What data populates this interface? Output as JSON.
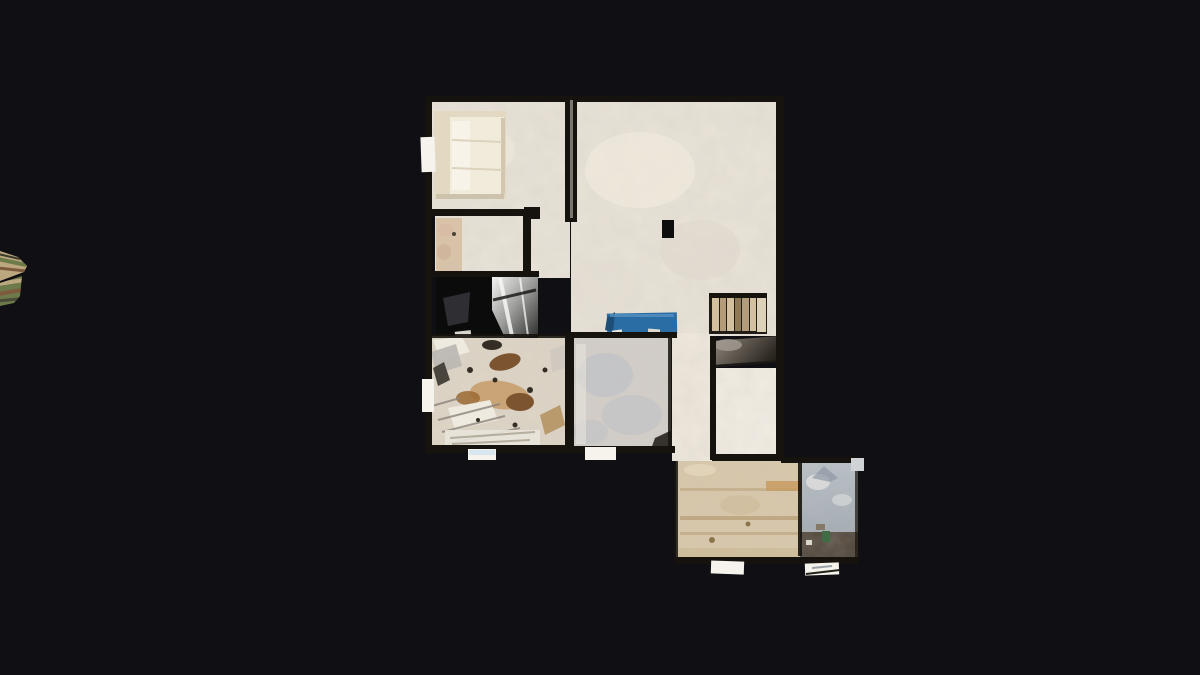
{
  "app": {
    "name": "3d-scan-floorplan-viewer",
    "view_mode": "top-down dollhouse floorplan",
    "visible_text": ""
  },
  "scene": {
    "description": "Orthographic top-down view of a 3D-scanned apartment floor on a black viewport; a small striped scan fragment clipped at the far left edge",
    "rooms": [
      {
        "id": "bedroom",
        "label": "bedroom with double bed"
      },
      {
        "id": "closet-room",
        "label": "small room with beige cabinet strip"
      },
      {
        "id": "dark-room",
        "label": "unlit room with reflective chrome surface"
      },
      {
        "id": "cluttered-room",
        "label": "heavily cluttered storage room"
      },
      {
        "id": "living-area",
        "label": "large open living area"
      },
      {
        "id": "stairwell",
        "label": "staircase with dark lower landing"
      },
      {
        "id": "rear-room",
        "label": "small white rear room"
      },
      {
        "id": "gray-room",
        "label": "room with gray-blue washed floor"
      },
      {
        "id": "hallway",
        "label": "hallway strip"
      },
      {
        "id": "garage-room",
        "label": "tan room lower right"
      },
      {
        "id": "patio",
        "label": "blue-gray patio with dark edge strip"
      }
    ],
    "objects": [
      {
        "id": "bed",
        "label": "bed with mattress and pillows"
      },
      {
        "id": "blue-bench",
        "label": "blue rectangular bench/table"
      },
      {
        "id": "column",
        "label": "small black column"
      },
      {
        "id": "stairs",
        "label": "stair treads seen from above"
      },
      {
        "id": "window-sills",
        "label": "small white sill tabs around perimeter"
      },
      {
        "id": "scan-fragment",
        "label": "striped scan fragment at left screen edge"
      }
    ],
    "palette": {
      "background": "#0f0f14",
      "wall": "#16130e",
      "wall_core": "#cfc8bd",
      "floor_light": "#e9e3d8",
      "floor_gray": "#d3cec9",
      "gray_wash": "#b9bfc7",
      "floor_white": "#f3eee5",
      "hallway": "#efe8dd",
      "floor_tan": "#d8c7a9",
      "tan_streak": "#b2996f",
      "dark_floor": "#0b0b0b",
      "clutter_base": "#ded5c6",
      "bed_frame": "#e3d9c2",
      "bed_mattress": "#f1ebdc",
      "pillow": "#f7f3e8",
      "blue_object": "#2a6da4",
      "blue_object_dark": "#1c4e78",
      "blue_highlight": "#5b93c4",
      "stair_light": "#d2c09f",
      "stair_mid": "#b29c79",
      "stair_dark": "#8f7a58",
      "stair_cap": "#ddd2b8",
      "wedge_light": "#948b80",
      "wedge_dark": "#26221c",
      "chrome_light": "#f2f2f0",
      "chrome_mid": "#9a9a98",
      "chrome_dark": "#2b2b29",
      "patio_top": "#b7c0c8",
      "patio_bottom": "#99a2aa",
      "patio_dark": "#4c4237",
      "beige_strip": "#d8c3a8",
      "tab_white": "#f5f3ec",
      "tab_blue": "#d7e6ef",
      "tab_gray": "#cfd3d6",
      "clutter_brown": "#7c5530",
      "clutter_tan": "#c59f6e",
      "clutter_rust": "#9b6a33",
      "clutter_dark": "#352e25",
      "clutter_white": "#efeae0",
      "fragment_tan": "#bca87e",
      "fragment_olive": "#6d7a4a",
      "fragment_brown": "#7d5a3c",
      "green_speck": "#3f6b45"
    }
  }
}
